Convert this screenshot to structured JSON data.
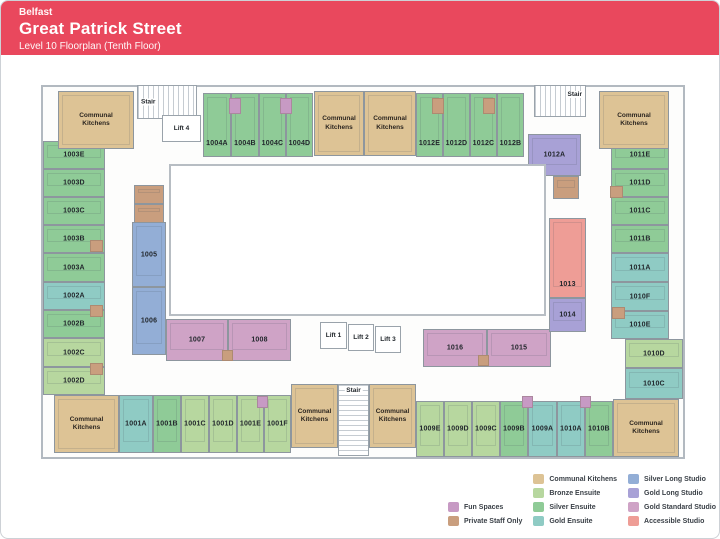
{
  "header": {
    "city": "Belfast",
    "title": "Great Patrick Street",
    "subtitle": "Level 10 Floorplan (Tenth Floor)",
    "bg": "#e9485d"
  },
  "category_colors": {
    "kitchen": "#ddc395",
    "bronze": "#b7d79f",
    "silver": "#8fcb97",
    "gold": "#8fcbc4",
    "silver_long": "#93aed6",
    "gold_long": "#a8a1d6",
    "gold_standard": "#cfa3c6",
    "accessible": "#ee9d96",
    "fun": "#c79ac4",
    "staff": "#c99e7e"
  },
  "floorplan": {
    "shell": {
      "x": 40,
      "y": 84,
      "w": 644,
      "h": 374
    },
    "courtyard": {
      "x": 168,
      "y": 163,
      "w": 377,
      "h": 152
    },
    "kitchen_label": "Communal Kitchens",
    "rooms": [
      {
        "l": "1003E",
        "t": "silver",
        "x": 42,
        "y": 140,
        "w": 62,
        "h": 28
      },
      {
        "l": "1003D",
        "t": "silver",
        "x": 42,
        "y": 168,
        "w": 62,
        "h": 28
      },
      {
        "l": "1003C",
        "t": "silver",
        "x": 42,
        "y": 196,
        "w": 62,
        "h": 28
      },
      {
        "l": "1003B",
        "t": "silver",
        "x": 42,
        "y": 224,
        "w": 62,
        "h": 28
      },
      {
        "l": "1003A",
        "t": "silver",
        "x": 42,
        "y": 252,
        "w": 62,
        "h": 29
      },
      {
        "l": "1002A",
        "t": "gold",
        "x": 42,
        "y": 281,
        "w": 62,
        "h": 28
      },
      {
        "l": "1002B",
        "t": "silver",
        "x": 42,
        "y": 309,
        "w": 62,
        "h": 28
      },
      {
        "l": "1002C",
        "t": "bronze",
        "x": 42,
        "y": 337,
        "w": 62,
        "h": 29
      },
      {
        "l": "1002D",
        "t": "bronze",
        "x": 42,
        "y": 366,
        "w": 62,
        "h": 28
      },
      {
        "l": "1004A",
        "t": "silver",
        "x": 202,
        "y": 92,
        "w": 28,
        "h": 64,
        "lp": "b"
      },
      {
        "l": "1004B",
        "t": "silver",
        "x": 230,
        "y": 92,
        "w": 28,
        "h": 64,
        "lp": "b"
      },
      {
        "l": "1004C",
        "t": "silver",
        "x": 258,
        "y": 92,
        "w": 27,
        "h": 64,
        "lp": "b"
      },
      {
        "l": "1004D",
        "t": "silver",
        "x": 285,
        "y": 92,
        "w": 27,
        "h": 64,
        "lp": "b"
      },
      {
        "l": "1012E",
        "t": "silver",
        "x": 415,
        "y": 92,
        "w": 27,
        "h": 64,
        "lp": "b"
      },
      {
        "l": "1012D",
        "t": "silver",
        "x": 442,
        "y": 92,
        "w": 27,
        "h": 64,
        "lp": "b"
      },
      {
        "l": "1012C",
        "t": "silver",
        "x": 469,
        "y": 92,
        "w": 27,
        "h": 64,
        "lp": "b"
      },
      {
        "l": "1012B",
        "t": "silver",
        "x": 496,
        "y": 92,
        "w": 27,
        "h": 64,
        "lp": "b"
      },
      {
        "l": "1012A",
        "t": "gold_long",
        "x": 527,
        "y": 133,
        "w": 53,
        "h": 42
      },
      {
        "l": "1011E",
        "t": "silver",
        "x": 610,
        "y": 140,
        "w": 58,
        "h": 28
      },
      {
        "l": "1011D",
        "t": "silver",
        "x": 610,
        "y": 168,
        "w": 58,
        "h": 28
      },
      {
        "l": "1011C",
        "t": "silver",
        "x": 610,
        "y": 196,
        "w": 58,
        "h": 28
      },
      {
        "l": "1011B",
        "t": "silver",
        "x": 610,
        "y": 224,
        "w": 58,
        "h": 28
      },
      {
        "l": "1011A",
        "t": "gold",
        "x": 610,
        "y": 252,
        "w": 58,
        "h": 29
      },
      {
        "l": "1010F",
        "t": "gold",
        "x": 610,
        "y": 281,
        "w": 58,
        "h": 29
      },
      {
        "l": "1010E",
        "t": "gold",
        "x": 610,
        "y": 310,
        "w": 58,
        "h": 28
      },
      {
        "l": "1010D",
        "t": "bronze",
        "x": 624,
        "y": 338,
        "w": 58,
        "h": 29
      },
      {
        "l": "1010C",
        "t": "gold",
        "x": 624,
        "y": 367,
        "w": 58,
        "h": 31
      },
      {
        "l": "1005",
        "t": "silver_long",
        "x": 131,
        "y": 221,
        "w": 34,
        "h": 65
      },
      {
        "l": "1006",
        "t": "silver_long",
        "x": 131,
        "y": 286,
        "w": 34,
        "h": 68
      },
      {
        "l": "1007",
        "t": "gold_standard",
        "x": 165,
        "y": 318,
        "w": 62,
        "h": 42
      },
      {
        "l": "1008",
        "t": "gold_standard",
        "x": 227,
        "y": 318,
        "w": 63,
        "h": 42
      },
      {
        "l": "1016",
        "t": "gold_standard",
        "x": 422,
        "y": 328,
        "w": 64,
        "h": 38
      },
      {
        "l": "1015",
        "t": "gold_standard",
        "x": 486,
        "y": 328,
        "w": 64,
        "h": 38
      },
      {
        "l": "1013",
        "t": "accessible",
        "x": 548,
        "y": 217,
        "w": 37,
        "h": 80,
        "lp": "b"
      },
      {
        "l": "1014",
        "t": "gold_long",
        "x": 548,
        "y": 297,
        "w": 37,
        "h": 34
      },
      {
        "l": "1001A",
        "t": "gold",
        "x": 118,
        "y": 394,
        "w": 34,
        "h": 58
      },
      {
        "l": "1001B",
        "t": "silver",
        "x": 152,
        "y": 394,
        "w": 28,
        "h": 58
      },
      {
        "l": "1001C",
        "t": "bronze",
        "x": 180,
        "y": 394,
        "w": 28,
        "h": 58
      },
      {
        "l": "1001D",
        "t": "bronze",
        "x": 208,
        "y": 394,
        "w": 28,
        "h": 58
      },
      {
        "l": "1001E",
        "t": "bronze",
        "x": 236,
        "y": 394,
        "w": 27,
        "h": 58
      },
      {
        "l": "1001F",
        "t": "bronze",
        "x": 263,
        "y": 394,
        "w": 27,
        "h": 58
      },
      {
        "l": "1009E",
        "t": "bronze",
        "x": 415,
        "y": 400,
        "w": 28,
        "h": 56
      },
      {
        "l": "1009D",
        "t": "bronze",
        "x": 443,
        "y": 400,
        "w": 28,
        "h": 56
      },
      {
        "l": "1009C",
        "t": "bronze",
        "x": 471,
        "y": 400,
        "w": 28,
        "h": 56
      },
      {
        "l": "1009B",
        "t": "silver",
        "x": 499,
        "y": 400,
        "w": 28,
        "h": 56
      },
      {
        "l": "1009A",
        "t": "gold",
        "x": 527,
        "y": 400,
        "w": 29,
        "h": 56
      },
      {
        "l": "1010A",
        "t": "gold",
        "x": 556,
        "y": 400,
        "w": 28,
        "h": 56
      },
      {
        "l": "1010B",
        "t": "silver",
        "x": 584,
        "y": 400,
        "w": 28,
        "h": 56
      }
    ],
    "kitchens": [
      {
        "x": 57,
        "y": 90,
        "w": 76,
        "h": 58
      },
      {
        "x": 313,
        "y": 90,
        "w": 50,
        "h": 65
      },
      {
        "x": 363,
        "y": 90,
        "w": 52,
        "h": 65
      },
      {
        "x": 598,
        "y": 90,
        "w": 70,
        "h": 58
      },
      {
        "x": 53,
        "y": 394,
        "w": 65,
        "h": 58
      },
      {
        "x": 290,
        "y": 383,
        "w": 47,
        "h": 64
      },
      {
        "x": 368,
        "y": 383,
        "w": 47,
        "h": 64
      },
      {
        "x": 612,
        "y": 398,
        "w": 66,
        "h": 58
      }
    ],
    "staff_rooms": [
      {
        "x": 133,
        "y": 184,
        "w": 30,
        "h": 19
      },
      {
        "x": 133,
        "y": 203,
        "w": 30,
        "h": 19
      },
      {
        "x": 552,
        "y": 175,
        "w": 26,
        "h": 23
      }
    ],
    "stairs": [
      {
        "label": "Stair",
        "x": 136,
        "y": 84,
        "w": 60,
        "h": 34,
        "lp": "left",
        "hatch": "v"
      },
      {
        "label": "Stair",
        "x": 533,
        "y": 84,
        "w": 52,
        "h": 32,
        "lp": "right",
        "hatch": "v"
      },
      {
        "label": "Stair",
        "x": 337,
        "y": 383,
        "w": 31,
        "h": 72,
        "lp": "top",
        "hatch": "h"
      }
    ],
    "lifts": [
      {
        "label": "Lift 4",
        "x": 161,
        "y": 114,
        "w": 39,
        "h": 27
      },
      {
        "label": "Lift 1",
        "x": 319,
        "y": 321,
        "w": 27,
        "h": 27
      },
      {
        "label": "Lift 2",
        "x": 347,
        "y": 323,
        "w": 26,
        "h": 27
      },
      {
        "label": "Lift 3",
        "x": 374,
        "y": 325,
        "w": 26,
        "h": 27
      }
    ],
    "markers": [
      {
        "x": 228,
        "y": 97,
        "w": 12,
        "h": 16,
        "t": "fun"
      },
      {
        "x": 279,
        "y": 97,
        "w": 12,
        "h": 16,
        "t": "fun"
      },
      {
        "x": 431,
        "y": 97,
        "w": 12,
        "h": 16,
        "t": "staff"
      },
      {
        "x": 482,
        "y": 97,
        "w": 12,
        "h": 16,
        "t": "staff"
      },
      {
        "x": 89,
        "y": 239,
        "w": 13,
        "h": 12,
        "t": "staff"
      },
      {
        "x": 89,
        "y": 304,
        "w": 13,
        "h": 12,
        "t": "staff"
      },
      {
        "x": 89,
        "y": 362,
        "w": 13,
        "h": 12,
        "t": "staff"
      },
      {
        "x": 609,
        "y": 185,
        "w": 13,
        "h": 12,
        "t": "staff"
      },
      {
        "x": 611,
        "y": 306,
        "w": 13,
        "h": 12,
        "t": "staff"
      },
      {
        "x": 256,
        "y": 395,
        "w": 11,
        "h": 12,
        "t": "fun"
      },
      {
        "x": 521,
        "y": 395,
        "w": 11,
        "h": 12,
        "t": "fun"
      },
      {
        "x": 579,
        "y": 395,
        "w": 11,
        "h": 12,
        "t": "fun"
      },
      {
        "x": 221,
        "y": 349,
        "w": 11,
        "h": 11,
        "t": "staff"
      },
      {
        "x": 477,
        "y": 354,
        "w": 11,
        "h": 11,
        "t": "staff"
      }
    ]
  },
  "legend": {
    "columns": [
      {
        "items": [
          {
            "label": "Fun Spaces",
            "color": "fun"
          },
          {
            "label": "Private Staff Only",
            "color": "staff"
          }
        ]
      },
      {
        "items": [
          {
            "label": "Communal Kitchens",
            "color": "kitchen"
          },
          {
            "label": "Bronze Ensuite",
            "color": "bronze"
          },
          {
            "label": "Silver Ensuite",
            "color": "silver"
          },
          {
            "label": "Gold Ensuite",
            "color": "gold"
          }
        ]
      },
      {
        "items": [
          {
            "label": "Silver Long Studio",
            "color": "silver_long"
          },
          {
            "label": "Gold Long Studio",
            "color": "gold_long"
          },
          {
            "label": "Gold Standard Studio",
            "color": "gold_standard"
          },
          {
            "label": "Accessible Studio",
            "color": "accessible"
          }
        ]
      }
    ]
  }
}
